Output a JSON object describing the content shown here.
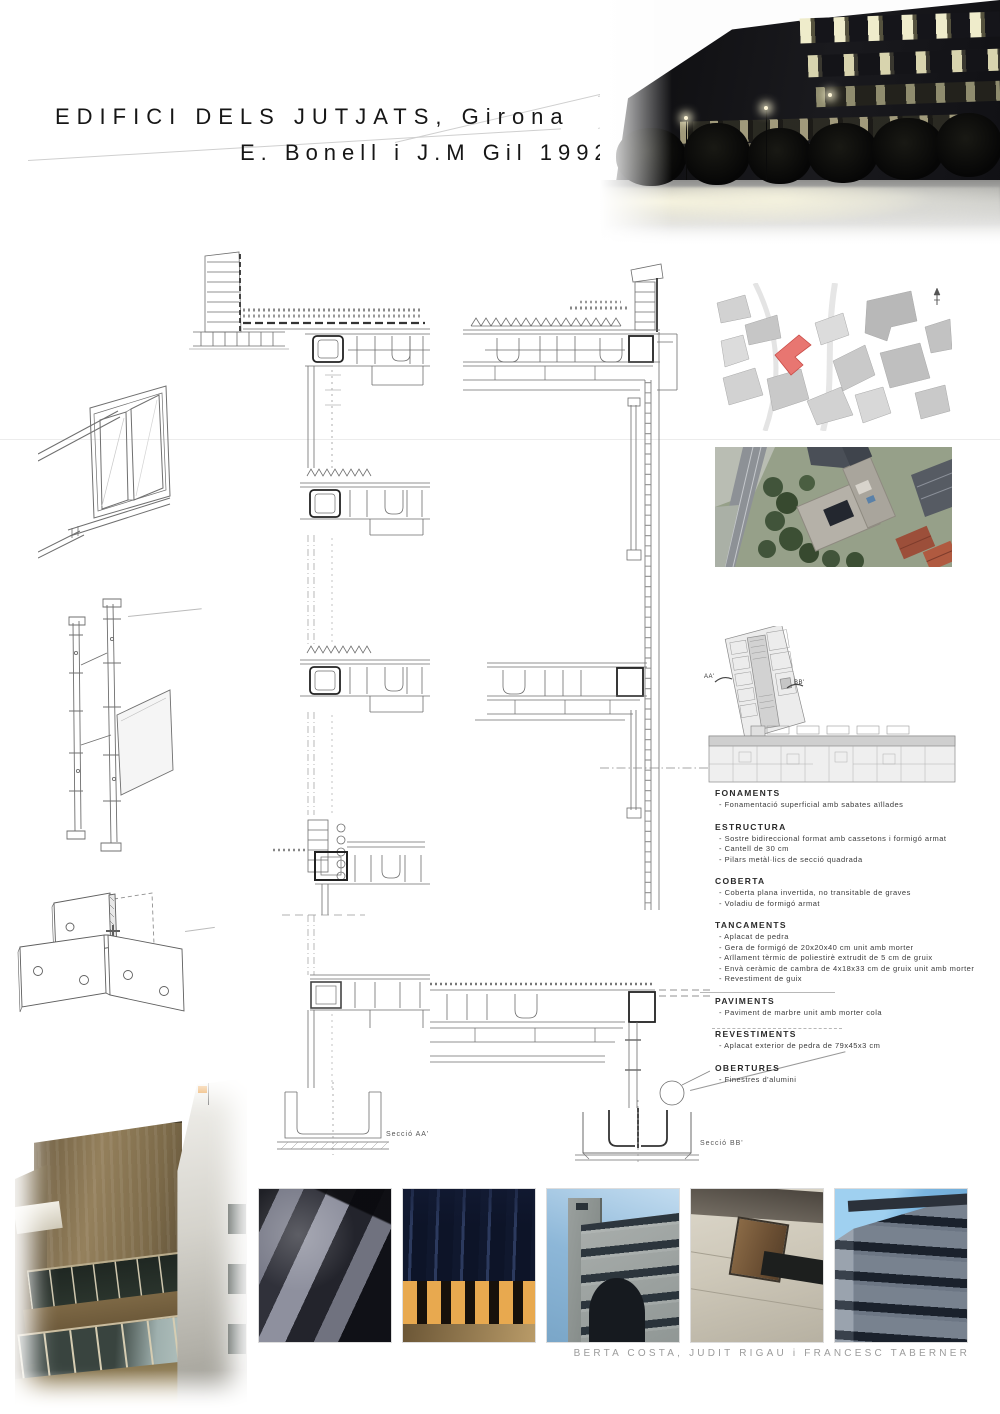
{
  "header": {
    "title_line1": "EDIFICI DELS JUTJATS, Girona",
    "title_line2": "E. Bonell i J.M Gil 1992"
  },
  "drawings": {
    "seccio_aa_label": "Secció AA'",
    "seccio_bb_label": "Secció BB'"
  },
  "plan": {
    "label_aa": "AA'",
    "label_bb": "BB'"
  },
  "specs": [
    {
      "heading": "FONAMENTS",
      "items": [
        "Fonamentació superficial amb sabates aïllades"
      ]
    },
    {
      "heading": "ESTRUCTURA",
      "items": [
        "Sostre bidireccional format amb cassetons i formigó armat",
        "Cantell de 30 cm",
        "Pilars metàl·lics de secció quadrada"
      ]
    },
    {
      "heading": "COBERTA",
      "items": [
        "Coberta plana invertida, no transitable de graves",
        "Voladiu de formigó armat"
      ]
    },
    {
      "heading": "TANCAMENTS",
      "items": [
        "Aplacat de pedra",
        "Gera de formigó de 20x20x40 cm unit amb morter",
        "Aïllament tèrmic de poliestirè extrudit de 5 cm de gruix",
        "Envà ceràmic de cambra de 4x18x33 cm de gruix unit amb morter",
        "Revestiment de guix"
      ]
    },
    {
      "heading": "PAVIMENTS",
      "items": [
        "Paviment de marbre unit amb morter cola"
      ]
    },
    {
      "heading": "REVESTIMENTS",
      "items": [
        "Aplacat exterior de pedra de 79x45x3 cm"
      ]
    },
    {
      "heading": "OBERTURES",
      "items": [
        "Finestres d'alumini"
      ]
    }
  ],
  "credits": "BERTA COSTA, JUDIT RIGAU i FRANCESC TABERNER",
  "colors": {
    "map_highlight": "#e87671",
    "map_highlight_stroke": "#c94b46"
  }
}
